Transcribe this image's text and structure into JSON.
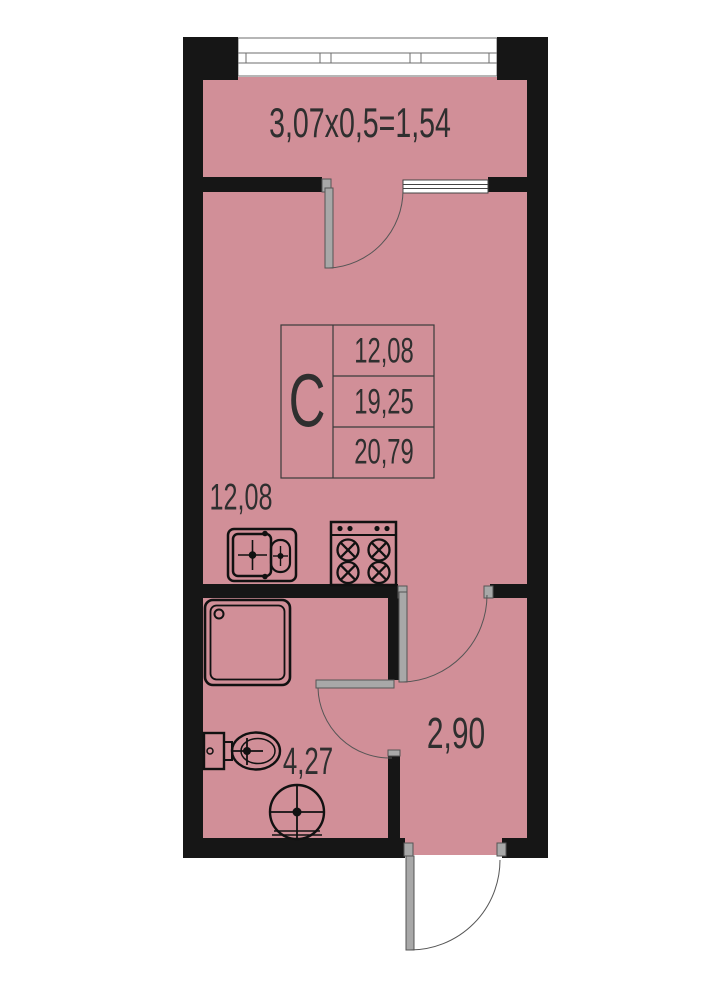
{
  "floor_plan": {
    "balcony": {
      "dimension_label": "3,07x0,5=1,54"
    },
    "unit_table": {
      "type_label": "C",
      "rows": [
        "12,08",
        "19,25",
        "20,79"
      ]
    },
    "room_labels": {
      "kitchen_living_area": "12,08",
      "bathroom_area": "4,27",
      "hallway_area": "2,90"
    },
    "fixtures": [
      "balcony-glazing",
      "balcony-window",
      "balcony-door",
      "room-door",
      "bathroom-door",
      "entrance-door",
      "kitchen-sink",
      "stove",
      "shower",
      "toilet",
      "washbasin"
    ],
    "colors": {
      "floor_fill": "#d18f98",
      "wall": "#161616",
      "door_leaf": "#a8a8a8",
      "text": "#2f2f2f"
    }
  }
}
